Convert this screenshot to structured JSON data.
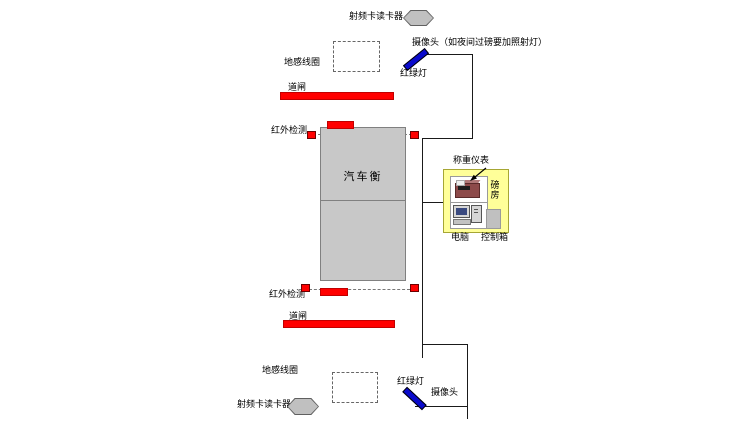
{
  "diagram_title": "汽车衡称重系统布置图",
  "colors": {
    "red": "#ff0000",
    "blue": "#0a0acc",
    "gray-fill": "#c0c0c0",
    "gray-border": "#808080",
    "scale-fill": "#c8c8c8",
    "yellow": "#ffff99",
    "line": "#1a1a1a"
  },
  "top": {
    "rfid_label": "射频卡读卡器",
    "camera_label": "摄像头（如夜间过磅要加照射灯）",
    "ground_coil_label": "地感线圈",
    "traffic_light_label": "红绿灯",
    "barrier_label": "道闸",
    "infrared_label": "红外检测"
  },
  "scale": {
    "label": "汽车衡"
  },
  "weigh_room": {
    "indicator_label": "称重仪表",
    "room_label": "磅房",
    "computer_label": "电脑",
    "control_box_label": "控制箱"
  },
  "bottom": {
    "infrared_label": "红外检测",
    "barrier_label": "道闸",
    "ground_coil_label": "地感线圈",
    "traffic_light_label": "红绿灯",
    "camera_label": "摄像头",
    "rfid_label": "射频卡读卡器"
  },
  "icons": {
    "rfid_reader": "hexagon-gray",
    "traffic_light": "blue-diagonal-bar",
    "infrared_sensor": "red-square",
    "barrier_gate": "red-bar",
    "ground_coil": "dashed-rectangle",
    "weighing_indicator": "desk-indicator-device",
    "computer": "desktop-computer",
    "control_box": "gray-box"
  }
}
